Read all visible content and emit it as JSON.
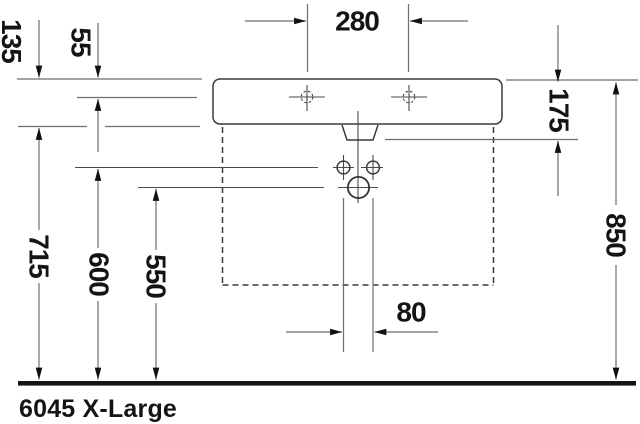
{
  "product": {
    "label": "6045 X-Large"
  },
  "dims": {
    "faucet_hole_spacing": "280",
    "basin_front_height": "135",
    "rim_to_faucet_center": "55",
    "rim_to_overflow_outlet": "175",
    "rim_height": "850",
    "underside_height": "715",
    "fixing_hole_height": "600",
    "drain_height": "550",
    "fixing_hole_distance": "80"
  },
  "colors": {
    "background": "#ffffff",
    "ink": "#141414",
    "object_line": "#3a3a3a",
    "dimension_line": "#6e6e6e"
  }
}
